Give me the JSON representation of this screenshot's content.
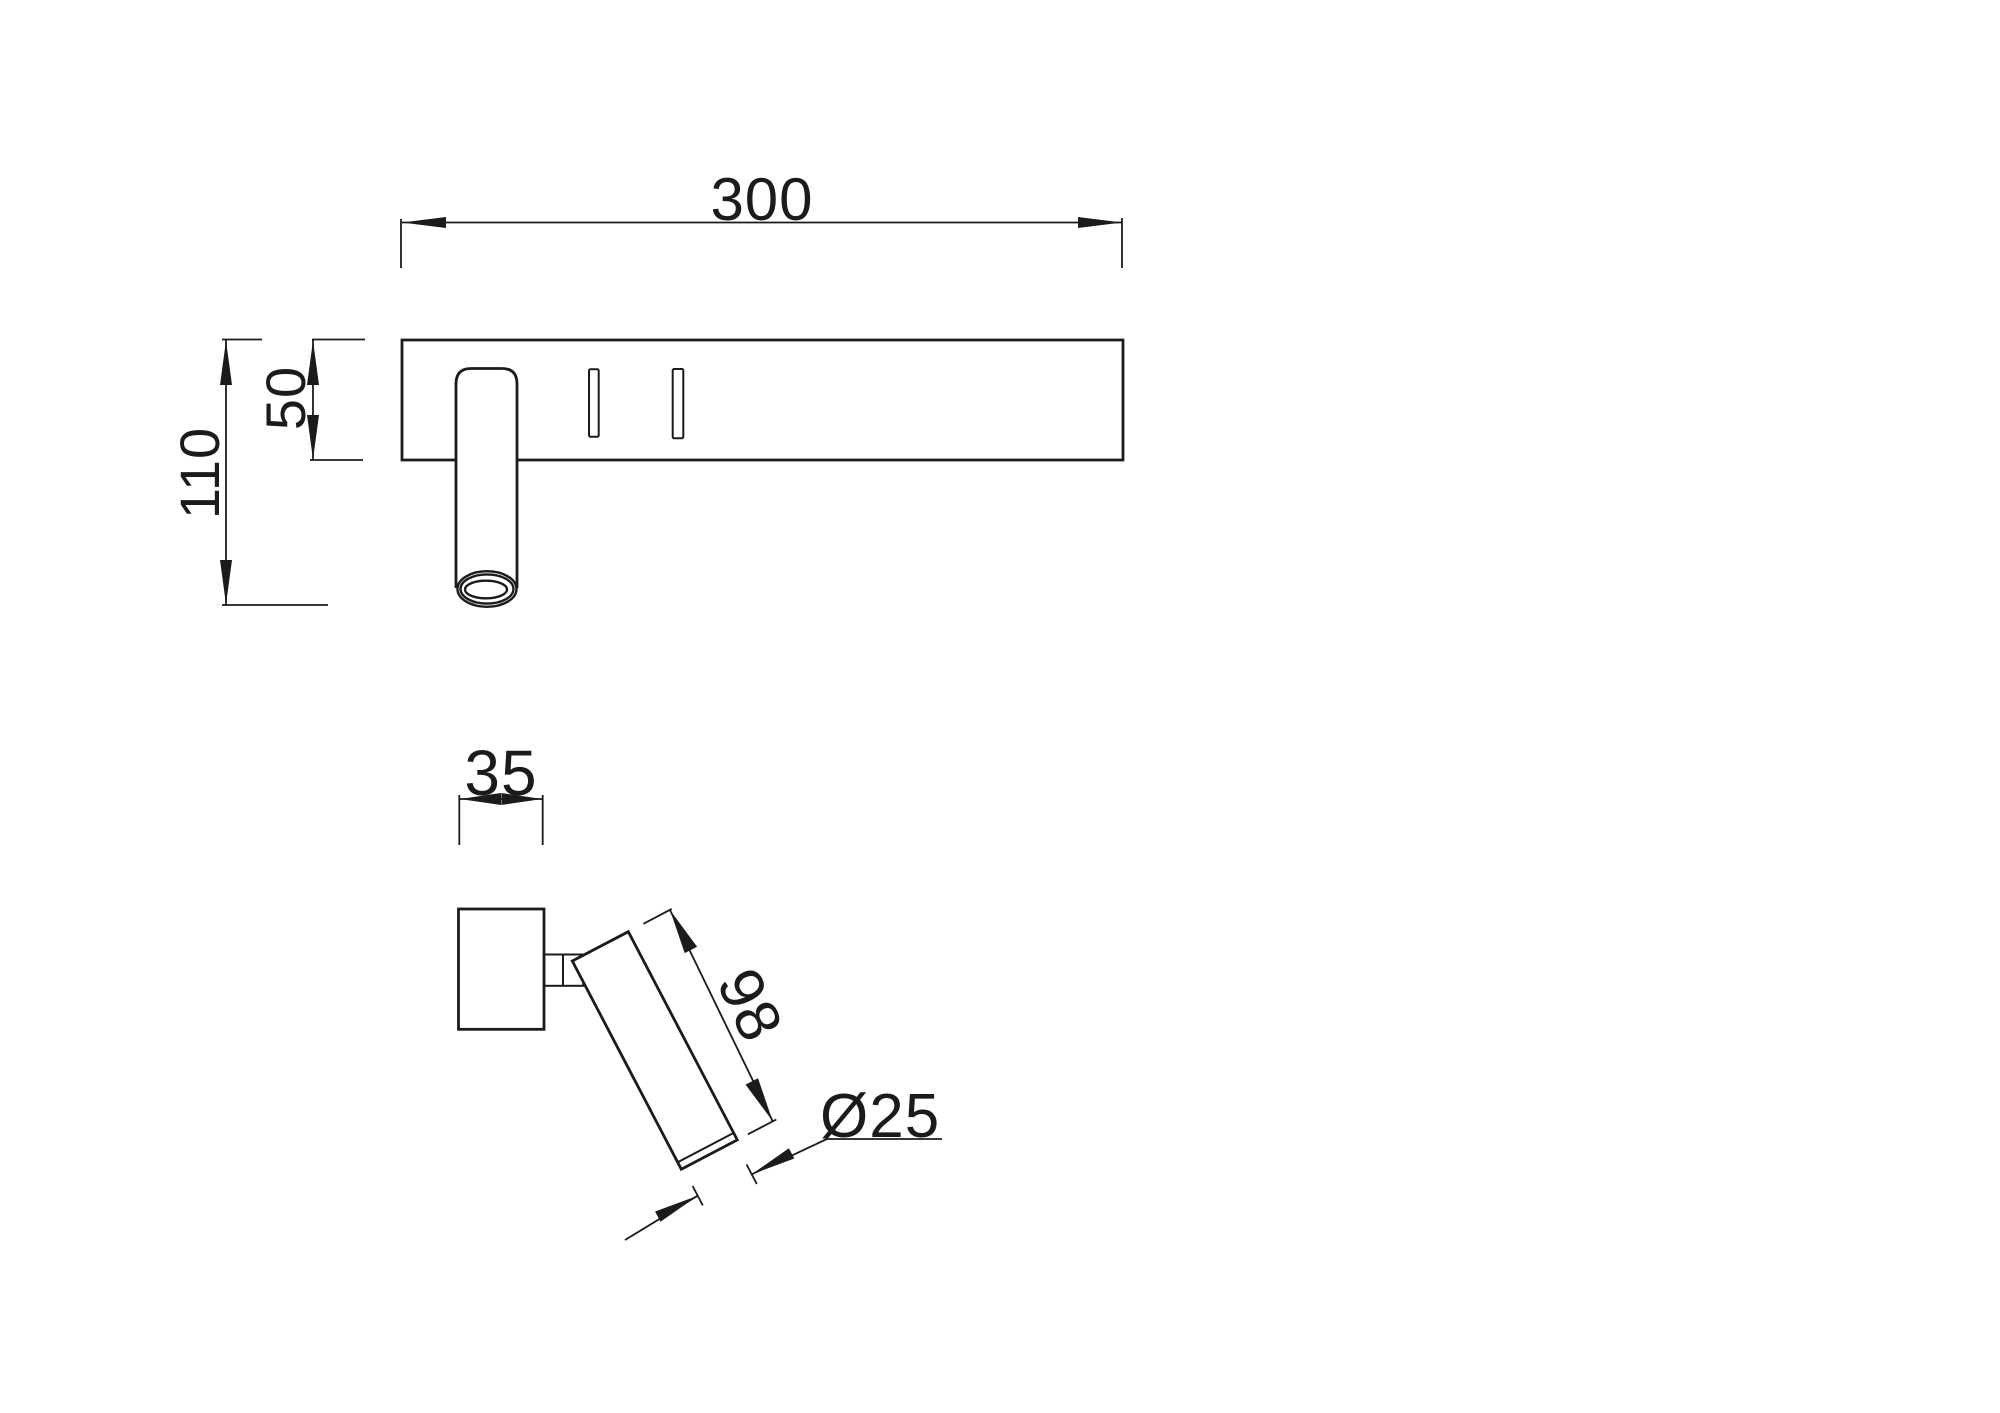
{
  "page": {
    "background_color": "#ffffff",
    "line_color": "#1b1b1b"
  },
  "drawing": {
    "front_view": {
      "dim_width": "300",
      "dim_plate_height": "50",
      "dim_total_height": "110"
    },
    "side_view": {
      "dim_depth": "35",
      "dim_head_length": "98",
      "dim_head_diameter": "Ø25"
    }
  }
}
